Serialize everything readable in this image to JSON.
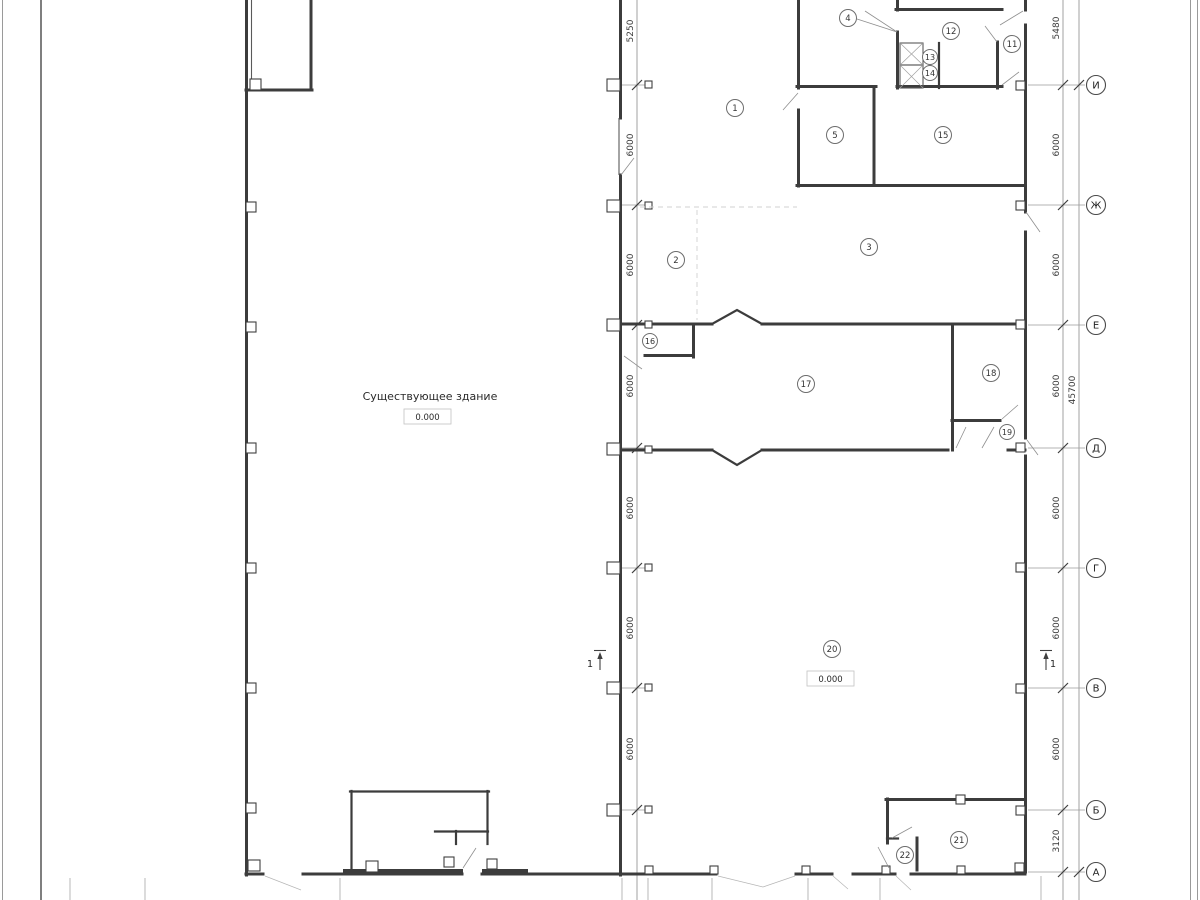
{
  "drawing": {
    "building_label": "Существующее здание",
    "elevation_building": "0.000",
    "elevation_room20": "0.000",
    "axes": [
      "И",
      "Ж",
      "Е",
      "Д",
      "Г",
      "В",
      "Б",
      "А"
    ],
    "dims_left": [
      "5250",
      "6000",
      "6000",
      "6000",
      "6000",
      "6000",
      "6000"
    ],
    "dims_right": [
      "5480",
      "6000",
      "6000",
      "6000",
      "6000",
      "6000",
      "6000",
      "3120"
    ],
    "dims_total": "45700",
    "rooms": [
      "1",
      "2",
      "3",
      "4",
      "5",
      "11",
      "12",
      "13",
      "14",
      "15",
      "16",
      "17",
      "18",
      "19",
      "20",
      "21",
      "22"
    ],
    "section_left": "1",
    "section_right": "1"
  }
}
